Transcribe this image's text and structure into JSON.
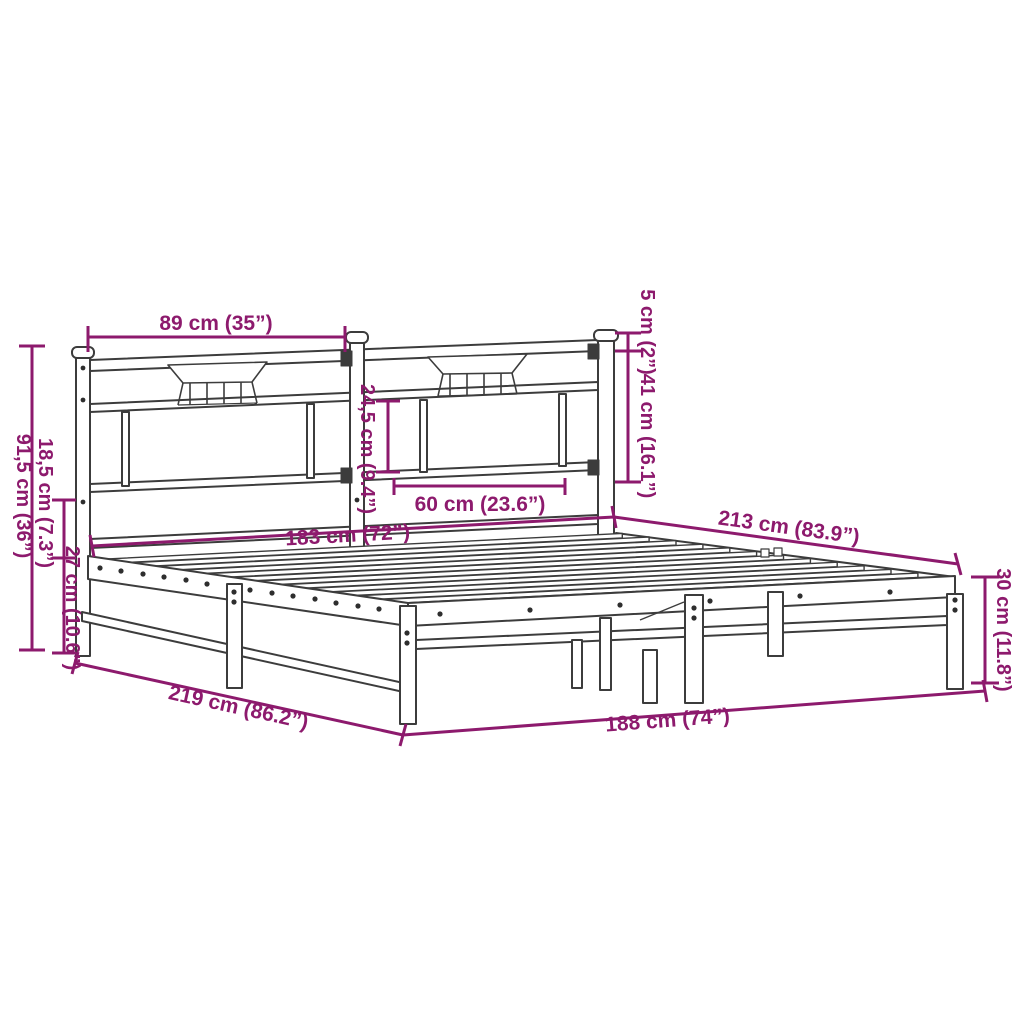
{
  "page": {
    "background": "#ffffff"
  },
  "colors": {
    "drawing_outline": "#3c3c3c",
    "dimension_accent": "#8d1a6d"
  },
  "diagram": {
    "subject": "metal bed frame with headboard",
    "style": "perspective line drawing with dimension callouts"
  },
  "dimensions": {
    "headboard_section_width": "89 cm (35”)",
    "post_cap_height": "5 cm (2”)",
    "headboard_upper_height": "41 cm (16.1”)",
    "headboard_panel_height": "24,5 cm (9.4”)",
    "headboard_panel_width": "60 cm (23.6”)",
    "slat_width": "183 cm (72”)",
    "inner_length": "213 cm (83.9”)",
    "headboard_height": "91,5 cm (36”)",
    "headboard_above_base": "18,5 cm (7.3”)",
    "underbed_clearance": "27 cm (10.6”)",
    "outer_length": "219 cm (86.2”)",
    "outer_width": "188 cm (74”)",
    "base_height": "30 cm (11.8”)"
  }
}
